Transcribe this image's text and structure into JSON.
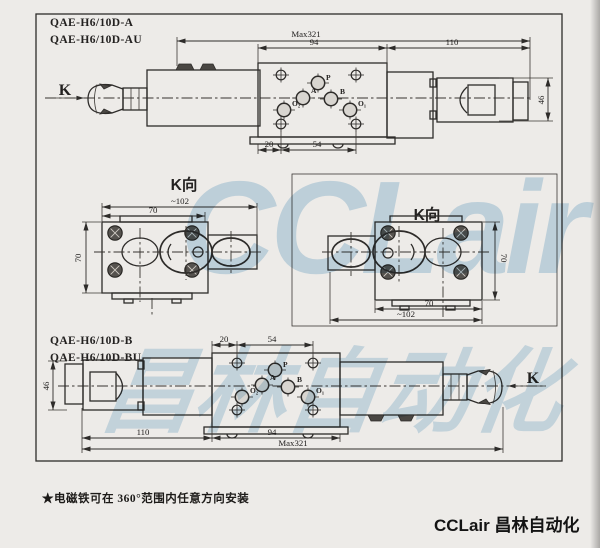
{
  "colors": {
    "paper": "#edebe8",
    "ink": "#2e2c2a",
    "watermark": "#7fb4d6"
  },
  "watermark": {
    "latin": "CCLair",
    "cjk": "昌林自动化"
  },
  "note": {
    "text": "★电磁铁可在 360°范围内任意方向安装"
  },
  "footer": {
    "brand": "CCLair 昌林自动化"
  },
  "drawing_a": {
    "model_line1": "QAE-H6/10D-A",
    "model_line2": "QAE-H6/10D-AU",
    "view_arrow": "K",
    "dims": {
      "overall": "Max321",
      "body": "94",
      "connector": "110",
      "height": "46",
      "offset": "20",
      "span": "54"
    },
    "ports": {
      "p": "P",
      "a": "A",
      "b": "B",
      "o2": "O₂",
      "o1": "O₁"
    }
  },
  "view_k_left": {
    "title": "K向",
    "dims": {
      "overall": "~102",
      "width": "70",
      "height": "70"
    }
  },
  "view_k_right": {
    "title": "K向",
    "dims": {
      "overall": "~102",
      "width": "70",
      "height": "70"
    }
  },
  "drawing_b": {
    "model_line1": "QAE-H6/10D-B",
    "model_line2": "QAE-H6/10D-BU",
    "view_arrow": "K",
    "dims": {
      "overall": "Max321",
      "body": "94",
      "connector": "110",
      "height": "46",
      "offset": "20",
      "span": "54"
    },
    "ports": {
      "p": "P",
      "a": "A",
      "b": "B",
      "o2": "O₂",
      "o1": "O₁"
    }
  }
}
